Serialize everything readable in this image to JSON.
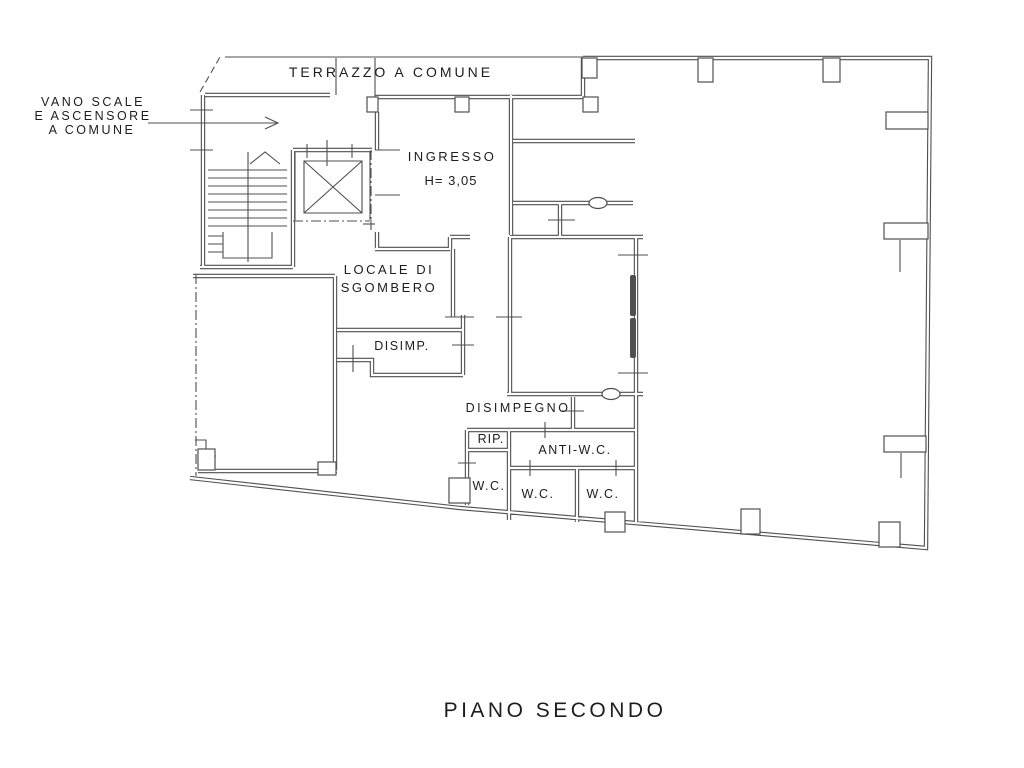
{
  "drawing": {
    "title": "PIANO SECONDO",
    "labels": {
      "terrace": "TERRAZZO A COMUNE",
      "stairwell_line1": "VANO SCALE",
      "stairwell_line2": "E ASCENSORE",
      "stairwell_line3": "A COMUNE",
      "entrance": "INGRESSO",
      "entrance_height": "H= 3,05",
      "storage_line1": "LOCALE DI",
      "storage_line2": "SGOMBERO",
      "hallway_abbrev": "DISIMP.",
      "hallway": "DISIMPEGNO",
      "closet": "RIP.",
      "anti_wc": "ANTI-W.C.",
      "wc_left": "W.C.",
      "wc_middle": "W.C.",
      "wc_right": "W.C."
    },
    "colors": {
      "line": "#4f4f4f",
      "text": "#1d1d1d",
      "background": "#ffffff"
    }
  }
}
